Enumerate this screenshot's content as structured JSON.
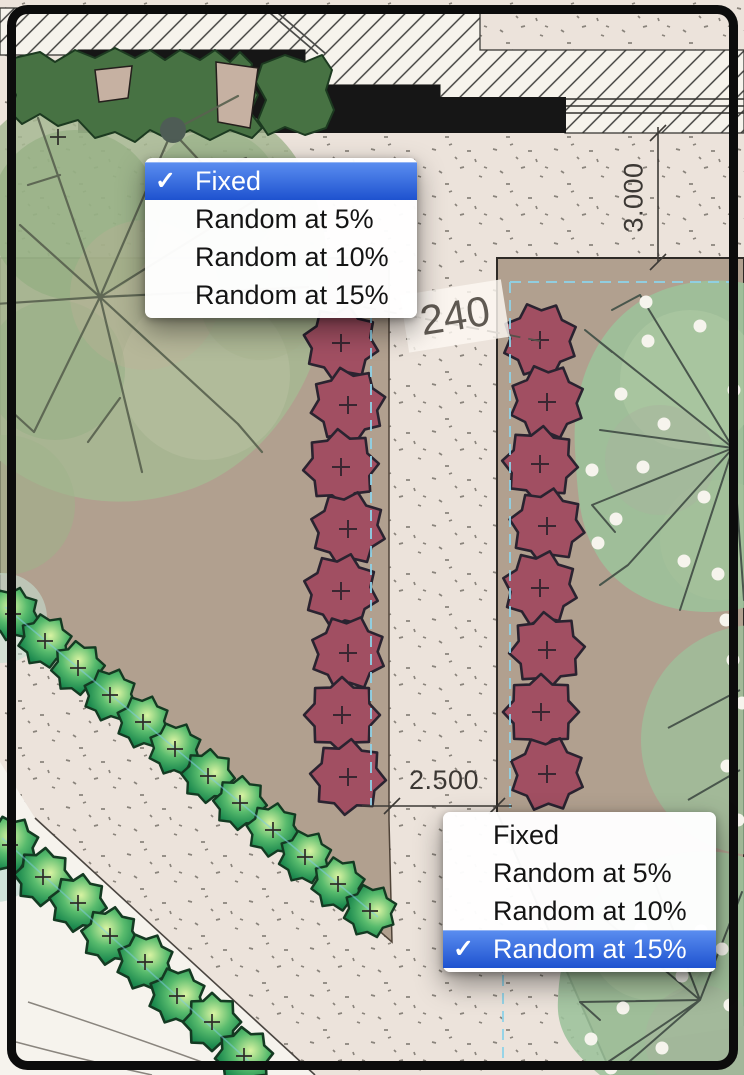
{
  "canvas": {
    "description": "landscape planting plan with plant-spacing context menus"
  },
  "glyphs": {
    "check": "✓"
  },
  "menus": {
    "top": {
      "items": [
        {
          "label": "Fixed",
          "checked": true
        },
        {
          "label": "Random at 5%",
          "checked": false
        },
        {
          "label": "Random at 10%",
          "checked": false
        },
        {
          "label": "Random at 15%",
          "checked": false
        }
      ]
    },
    "bottom": {
      "items": [
        {
          "label": "Fixed",
          "checked": false
        },
        {
          "label": "Random at 5%",
          "checked": false
        },
        {
          "label": "Random at 10%",
          "checked": false
        },
        {
          "label": "Random at 15%",
          "checked": true
        }
      ]
    }
  },
  "annotations": {
    "vertical_dimension": "3.000",
    "horizontal_dimension": "2.500",
    "spacing_label": "240"
  },
  "colors": {
    "menu_highlight_top": "#5b8ef0",
    "menu_highlight_bottom": "#1e52cf",
    "hedge_maroon": "#a14f62",
    "hedge_green": "#2f9e5b",
    "bed_tan": "#b1a08f",
    "path_light": "#ece3db",
    "lawn_white": "#f6f3ed",
    "wall_black": "#161616",
    "big_tree_canopy": "#a7b993",
    "dotted_tree_canopy": "#9cc29b",
    "selection_cyan": "#8ed2e8"
  }
}
